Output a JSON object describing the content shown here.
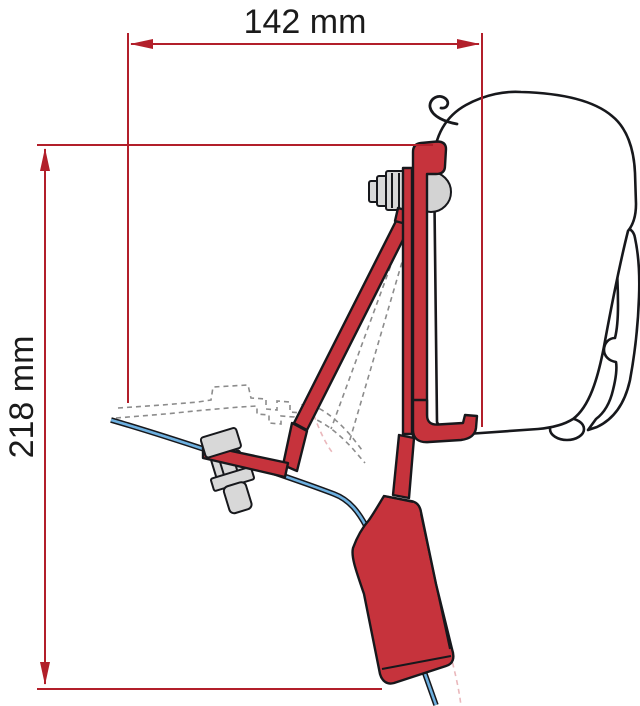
{
  "dimensions": {
    "width_label": "142 mm",
    "height_label": "218 mm"
  },
  "colors": {
    "background": "#ffffff",
    "dimension_red": "#b21f2a",
    "bracket_red": "#c6333c",
    "outline_black": "#17181c",
    "rail_blue": "#6db0e0",
    "hardware_gray": "#d8d8d8",
    "knuckle_gray": "#d3d3d3",
    "dashed_gray": "#8c8c8c",
    "dashed_pink": "#eab8bc",
    "label_black": "#1b1b1b"
  }
}
